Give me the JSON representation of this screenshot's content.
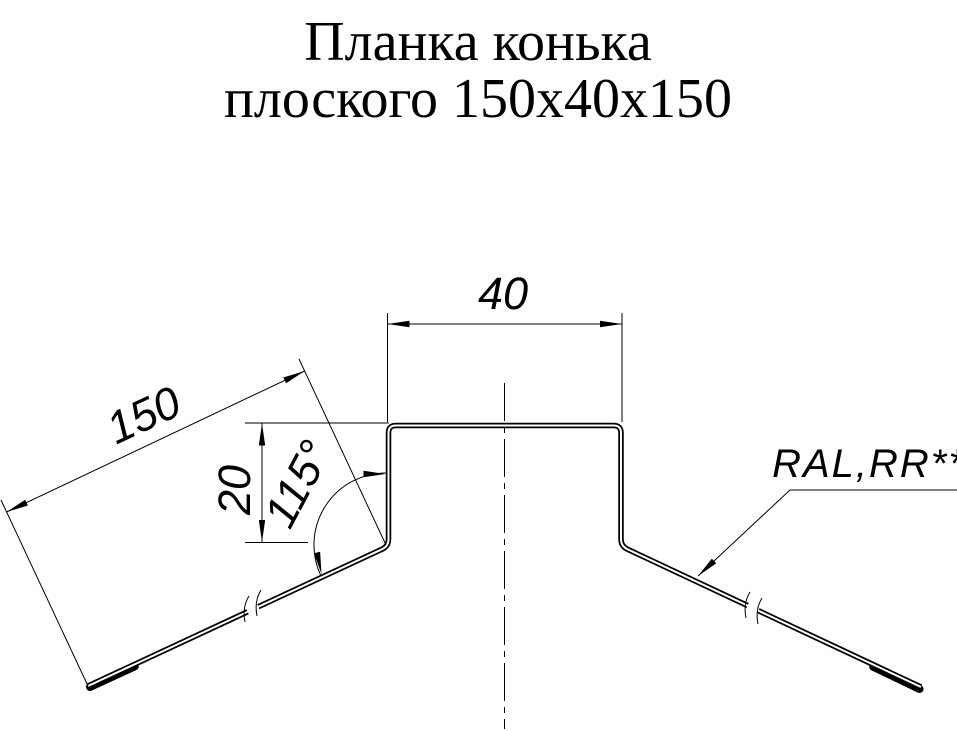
{
  "title": {
    "line1": "Планка конька",
    "line2": "плоского 150x40x150"
  },
  "dimensions": {
    "top_width": "40",
    "height": "20",
    "slope_length": "150",
    "angle": "115°"
  },
  "labels": {
    "coating": "RAL,RR**"
  },
  "style": {
    "line_color": "#000000",
    "background": "#ffffff"
  }
}
